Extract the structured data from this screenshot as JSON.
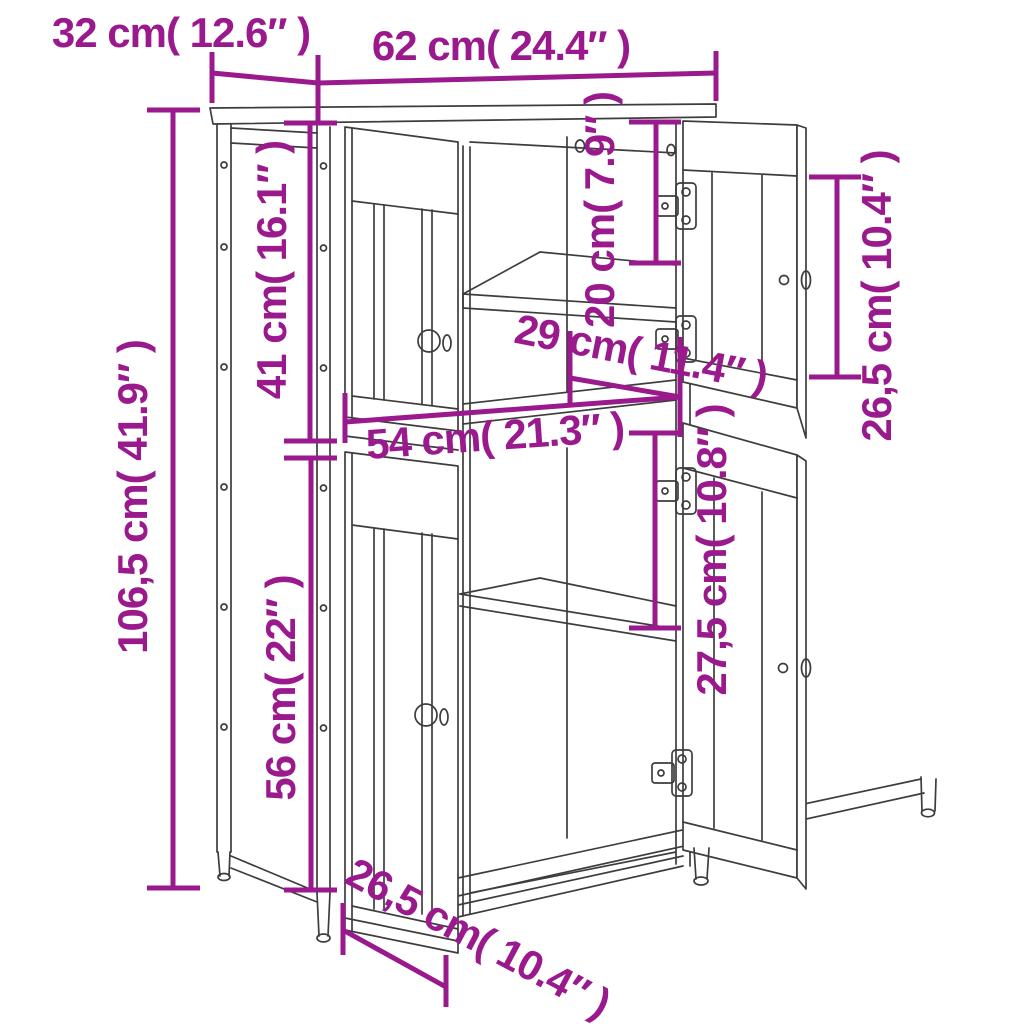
{
  "figure": {
    "type": "product-dimension-diagram",
    "product": "two-section cabinet with four doors",
    "colors": {
      "dimension": "#9a1a8e",
      "line": "#3d3d3d",
      "background": "#ffffff"
    },
    "labels": [
      {
        "id": "top-depth",
        "text": "32 cm( 12.6″ )"
      },
      {
        "id": "top-width",
        "text": "62 cm( 24.4″ )"
      },
      {
        "id": "overall-height",
        "text": "106,5 cm( 41.9″ )"
      },
      {
        "id": "upper-section-height",
        "text": "41 cm( 16.1″ )"
      },
      {
        "id": "top-compartment",
        "text": "20 cm( 7.9″ )"
      },
      {
        "id": "inner-depth",
        "text": "29 cm( 11.4″ )"
      },
      {
        "id": "inner-width",
        "text": "54 cm( 21.3″ )"
      },
      {
        "id": "right-door-height",
        "text": "26,5 cm( 10.4″ )"
      },
      {
        "id": "lower-compartment",
        "text": "27,5 cm( 10.8″ )"
      },
      {
        "id": "lower-section-height",
        "text": "56 cm( 22″ )"
      },
      {
        "id": "base-depth",
        "text": "26,5 cm( 10.4″ )"
      }
    ]
  }
}
